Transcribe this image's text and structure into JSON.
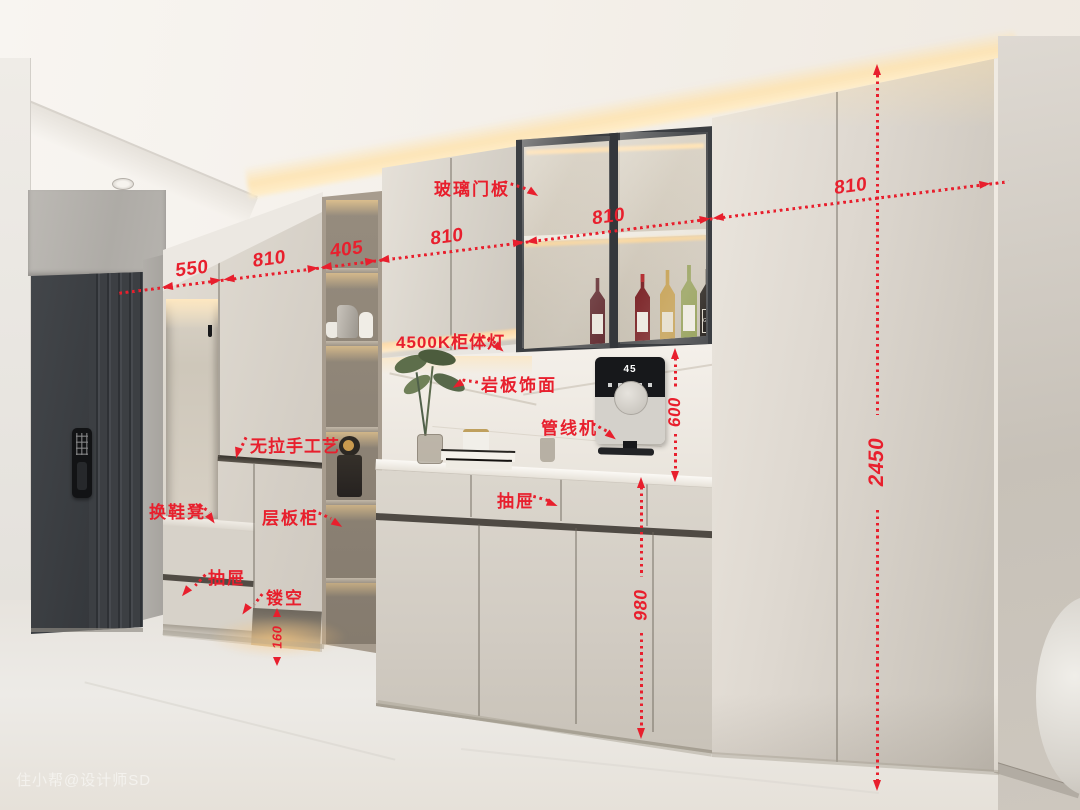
{
  "watermark": {
    "text": "住小帮@设计师SD"
  },
  "palette": {
    "annotation_red": "#e81f2d",
    "cabinet_greige": "#d9d4cb",
    "door_charcoal": "#3a3d41",
    "wood_tower": "#a79c8e",
    "led_glow": "#ffd9a2",
    "glass_frame_black": "#3b3e42",
    "marble_white": "#f3efe9"
  },
  "annotations": {
    "chain": [
      {
        "label": "550"
      },
      {
        "label": "810"
      },
      {
        "label": "405"
      },
      {
        "label": "810"
      },
      {
        "label": "810"
      },
      {
        "label": "810"
      }
    ],
    "vertical": [
      {
        "label": "2450"
      },
      {
        "label": "600"
      },
      {
        "label": "980"
      },
      {
        "label": "160"
      }
    ],
    "leaders": [
      {
        "text": "玻璃门板"
      },
      {
        "text": "4500K柜体灯"
      },
      {
        "text": "岩板饰面"
      },
      {
        "text": "管线机"
      },
      {
        "text": "抽屉"
      },
      {
        "text": "无拉手工艺"
      },
      {
        "text": "换鞋凳"
      },
      {
        "text": "层板柜"
      },
      {
        "text": "抽屉"
      },
      {
        "text": "镂空"
      }
    ]
  },
  "objects": {
    "wine_label": "GAJA",
    "dispenser_display": "45"
  }
}
